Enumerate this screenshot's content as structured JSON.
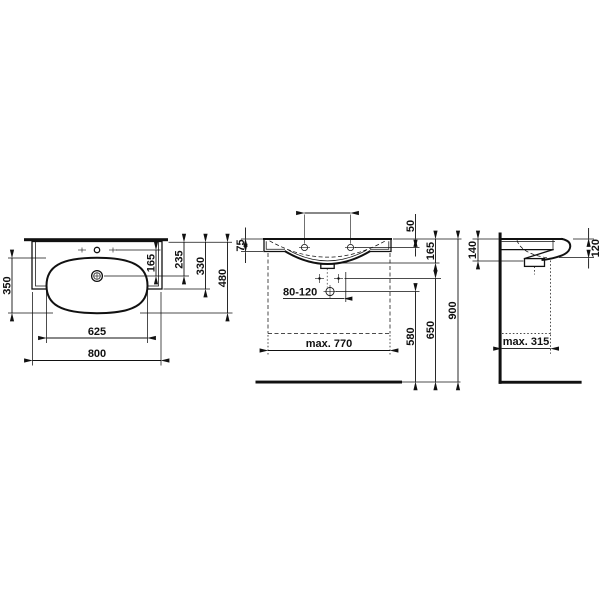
{
  "background_color": "#ffffff",
  "line_color": "#111111",
  "views": {
    "plan": {
      "dims": {
        "overall_width": "800",
        "bowl_width": "625",
        "bowl_depth": "350",
        "tap_to_drain": "165",
        "back_to_drain": "235",
        "back_to_front_edge": "330",
        "overall_depth": "480"
      }
    },
    "front": {
      "dims": {
        "side_edge_height": "75",
        "rim_to_fixing_holes": "50",
        "ceramic_height": "165",
        "trap_outlet_height": "580",
        "valves_height": "650",
        "rim_height": "900",
        "trap_offset_range": "80-120",
        "furniture_max_width": "max. 770"
      }
    },
    "side": {
      "dims": {
        "rear_ceramic_height": "140",
        "front_edge_height": "120",
        "furniture_max_depth": "max. 315"
      }
    }
  }
}
